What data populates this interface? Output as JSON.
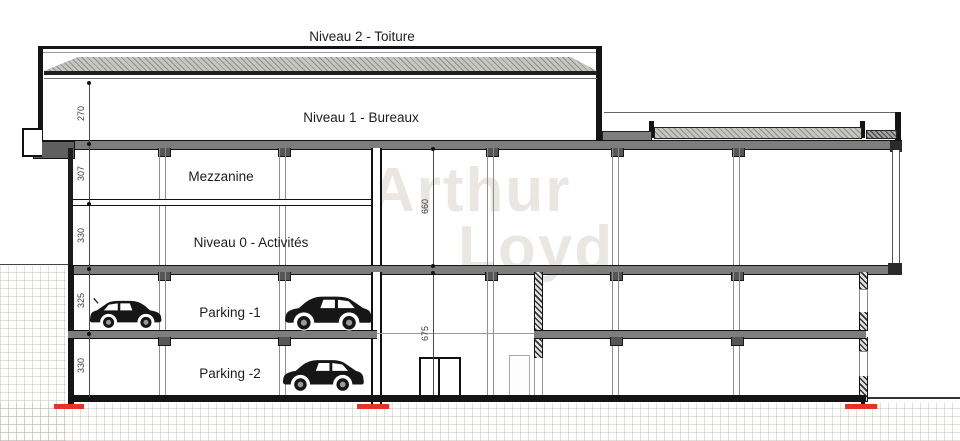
{
  "levels": [
    {
      "label": "Niveau 2 - Toiture"
    },
    {
      "label": "Niveau 1 - Bureaux",
      "height": "270"
    },
    {
      "label": "Mezzanine",
      "height": "307"
    },
    {
      "label": "Niveau 0 - Activités",
      "height": "330"
    },
    {
      "label": "Parking -1",
      "height": "325"
    },
    {
      "label": "Parking -2",
      "height": "330"
    }
  ],
  "overall_dims": {
    "niveau0_zone_total": "660",
    "parking_zone_total": "675"
  },
  "watermark": {
    "line1": "Arthur",
    "line2": "Loyd"
  },
  "icons": {
    "vehicles": [
      "car-icon",
      "car-icon",
      "car-icon"
    ],
    "foundation_markers": 3
  },
  "colors": {
    "line": "#1a1a1a",
    "slab_gray": "#7d7d7d",
    "roof_hatch": "#c7c6c3",
    "foundation_red": "#e63229",
    "dimension_text": "#3d3d3d",
    "watermark": "#d6cfc5"
  }
}
